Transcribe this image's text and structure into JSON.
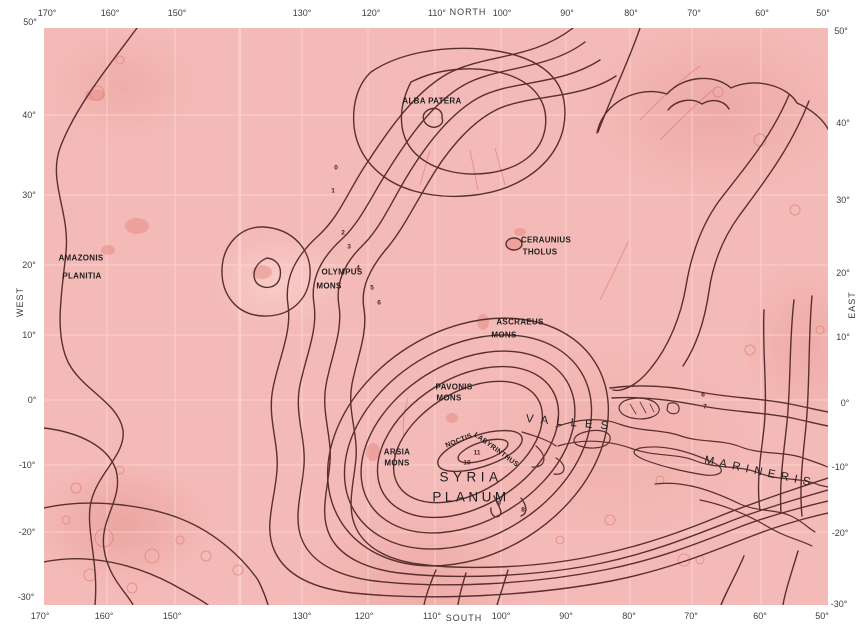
{
  "map": {
    "colors": {
      "map_fill": "#f4bab7",
      "contour": "#5a2f2f",
      "detail_red": "#de6a61",
      "grid": "#ffe6e3",
      "label": "#1e1e1e"
    },
    "axis_labels": {
      "top": [
        {
          "name": "lon-tick",
          "text": "170°",
          "x": 47,
          "y": 13
        },
        {
          "name": "lon-tick",
          "text": "160°",
          "x": 110,
          "y": 13
        },
        {
          "name": "lon-tick",
          "text": "150°",
          "x": 177,
          "y": 13
        },
        {
          "name": "lon-tick",
          "text": "130°",
          "x": 302,
          "y": 13
        },
        {
          "name": "lon-tick",
          "text": "120°",
          "x": 371,
          "y": 13
        },
        {
          "name": "lon-tick",
          "text": "110°",
          "x": 437,
          "y": 13
        },
        {
          "name": "north-label",
          "text": "NORTH",
          "x": 468,
          "y": 12,
          "ls": 1
        },
        {
          "name": "lon-tick",
          "text": "100°",
          "x": 502,
          "y": 13
        },
        {
          "name": "lon-tick",
          "text": "90°",
          "x": 567,
          "y": 13
        },
        {
          "name": "lon-tick",
          "text": "80°",
          "x": 631,
          "y": 13
        },
        {
          "name": "lon-tick",
          "text": "70°",
          "x": 694,
          "y": 13
        },
        {
          "name": "lon-tick",
          "text": "60°",
          "x": 762,
          "y": 13
        },
        {
          "name": "lon-tick",
          "text": "50°",
          "x": 823,
          "y": 13
        }
      ],
      "bottom": [
        {
          "name": "lon-tick",
          "text": "170°",
          "x": 40,
          "y": 616
        },
        {
          "name": "lon-tick",
          "text": "160°",
          "x": 104,
          "y": 616
        },
        {
          "name": "lon-tick",
          "text": "150°",
          "x": 172,
          "y": 616
        },
        {
          "name": "lon-tick",
          "text": "130°",
          "x": 302,
          "y": 616
        },
        {
          "name": "lon-tick",
          "text": "120°",
          "x": 364,
          "y": 616
        },
        {
          "name": "lon-tick",
          "text": "110°",
          "x": 432,
          "y": 616
        },
        {
          "name": "south-label",
          "text": "SOUTH",
          "x": 464,
          "y": 618,
          "ls": 1
        },
        {
          "name": "lon-tick",
          "text": "100°",
          "x": 501,
          "y": 616
        },
        {
          "name": "lon-tick",
          "text": "90°",
          "x": 566,
          "y": 616
        },
        {
          "name": "lon-tick",
          "text": "80°",
          "x": 629,
          "y": 616
        },
        {
          "name": "lon-tick",
          "text": "70°",
          "x": 691,
          "y": 616
        },
        {
          "name": "lon-tick",
          "text": "60°",
          "x": 760,
          "y": 616
        },
        {
          "name": "lon-tick",
          "text": "50°",
          "x": 822,
          "y": 616
        }
      ],
      "left": [
        {
          "name": "lat-tick",
          "text": "50°",
          "x": 30,
          "y": 22
        },
        {
          "name": "lat-tick",
          "text": "40°",
          "x": 29,
          "y": 115
        },
        {
          "name": "lat-tick",
          "text": "30°",
          "x": 29,
          "y": 195
        },
        {
          "name": "lat-tick",
          "text": "20°",
          "x": 29,
          "y": 265
        },
        {
          "name": "west-label",
          "text": "WEST",
          "x": 20,
          "y": 302,
          "rot": -90,
          "ls": 1
        },
        {
          "name": "lat-tick",
          "text": "10°",
          "x": 29,
          "y": 335
        },
        {
          "name": "lat-tick",
          "text": "0°",
          "x": 32,
          "y": 400
        },
        {
          "name": "lat-tick",
          "text": "-10°",
          "x": 27,
          "y": 465
        },
        {
          "name": "lat-tick",
          "text": "-20°",
          "x": 27,
          "y": 532
        },
        {
          "name": "lat-tick",
          "text": "-30°",
          "x": 26,
          "y": 597
        }
      ],
      "right": [
        {
          "name": "lat-tick",
          "text": "50°",
          "x": 841,
          "y": 31
        },
        {
          "name": "lat-tick",
          "text": "40°",
          "x": 843,
          "y": 123
        },
        {
          "name": "lat-tick",
          "text": "30°",
          "x": 843,
          "y": 200
        },
        {
          "name": "lat-tick",
          "text": "20°",
          "x": 843,
          "y": 273
        },
        {
          "name": "east-label",
          "text": "EAST",
          "x": 852,
          "y": 305,
          "rot": -90,
          "ls": 1
        },
        {
          "name": "lat-tick",
          "text": "10°",
          "x": 843,
          "y": 337
        },
        {
          "name": "lat-tick",
          "text": "0°",
          "x": 845,
          "y": 403
        },
        {
          "name": "lat-tick",
          "text": "-10°",
          "x": 840,
          "y": 467
        },
        {
          "name": "lat-tick",
          "text": "-20°",
          "x": 840,
          "y": 533
        },
        {
          "name": "lat-tick",
          "text": "-30°",
          "x": 839,
          "y": 604
        }
      ]
    },
    "features": [
      {
        "name": "amazonis-planitia-label",
        "text": "AMAZONIS",
        "x": 81,
        "y": 258
      },
      {
        "name": "amazonis-planitia-label",
        "text": "PLANITIA",
        "x": 82,
        "y": 276
      },
      {
        "name": "alba-patera-label",
        "text": "ALBA PATERA",
        "x": 432,
        "y": 101
      },
      {
        "name": "olympus-mons-label",
        "text": "OLYMPUS",
        "x": 342,
        "y": 272
      },
      {
        "name": "olympus-mons-label",
        "text": "MONS",
        "x": 329,
        "y": 286
      },
      {
        "name": "ceraunius-tholus-label",
        "text": "CERAUNIUS",
        "x": 546,
        "y": 240
      },
      {
        "name": "ceraunius-tholus-label",
        "text": "THOLUS",
        "x": 540,
        "y": 252
      },
      {
        "name": "ascraeus-mons-label",
        "text": "ASCRAEUS",
        "x": 520,
        "y": 322
      },
      {
        "name": "ascraeus-mons-label",
        "text": "MONS",
        "x": 504,
        "y": 335
      },
      {
        "name": "pavonis-mons-label",
        "text": "PAVONIS",
        "x": 454,
        "y": 387
      },
      {
        "name": "pavonis-mons-label",
        "text": "MONS",
        "x": 449,
        "y": 398
      },
      {
        "name": "arsia-mons-label",
        "text": "ARSIA",
        "x": 397,
        "y": 452
      },
      {
        "name": "arsia-mons-label",
        "text": "MONS",
        "x": 397,
        "y": 463
      },
      {
        "name": "noctis-labyrinthus-label",
        "text": "NOCTIS",
        "x": 459,
        "y": 441,
        "rot": -22,
        "size": 7
      },
      {
        "name": "noctis-labyrinthus-label",
        "text": "LABYRINTHUS",
        "x": 496,
        "y": 450,
        "rot": 36,
        "size": 7
      },
      {
        "name": "syria-planum-label",
        "text": "SYRIA",
        "x": 471,
        "y": 477,
        "size": 13.5,
        "ls": 4.5,
        "weight": 400
      },
      {
        "name": "syria-planum-label",
        "text": "PLANUM",
        "x": 471,
        "y": 497,
        "size": 13.5,
        "ls": 3.5,
        "weight": 400
      },
      {
        "name": "valles-marineris-label",
        "text": "VALLES",
        "x": 571,
        "y": 423,
        "size": 11.5,
        "ls": 8,
        "rot": 5,
        "weight": 400
      },
      {
        "name": "valles-marineris-label",
        "text": "MARINERIS",
        "x": 760,
        "y": 472,
        "size": 11.5,
        "ls": 5.5,
        "rot": 12,
        "weight": 400
      }
    ],
    "contour_labels": [
      {
        "name": "contour-elevation-label",
        "text": "0",
        "x": 336,
        "y": 168
      },
      {
        "name": "contour-elevation-label",
        "text": "1",
        "x": 333,
        "y": 191
      },
      {
        "name": "contour-elevation-label",
        "text": "2",
        "x": 343,
        "y": 233
      },
      {
        "name": "contour-elevation-label",
        "text": "3",
        "x": 349,
        "y": 247
      },
      {
        "name": "contour-elevation-label",
        "text": "4",
        "x": 358,
        "y": 268
      },
      {
        "name": "contour-elevation-label",
        "text": "5",
        "x": 372,
        "y": 288
      },
      {
        "name": "contour-elevation-label",
        "text": "6",
        "x": 379,
        "y": 303
      },
      {
        "name": "contour-elevation-label",
        "text": "6",
        "x": 703,
        "y": 395
      },
      {
        "name": "contour-elevation-label",
        "text": "7",
        "x": 705,
        "y": 407
      },
      {
        "name": "contour-elevation-label",
        "text": "11",
        "x": 477,
        "y": 453
      },
      {
        "name": "contour-elevation-label",
        "text": "10",
        "x": 467,
        "y": 463
      },
      {
        "name": "contour-elevation-label",
        "text": "9",
        "x": 499,
        "y": 504
      },
      {
        "name": "contour-elevation-label",
        "text": "8",
        "x": 523,
        "y": 510
      }
    ]
  }
}
